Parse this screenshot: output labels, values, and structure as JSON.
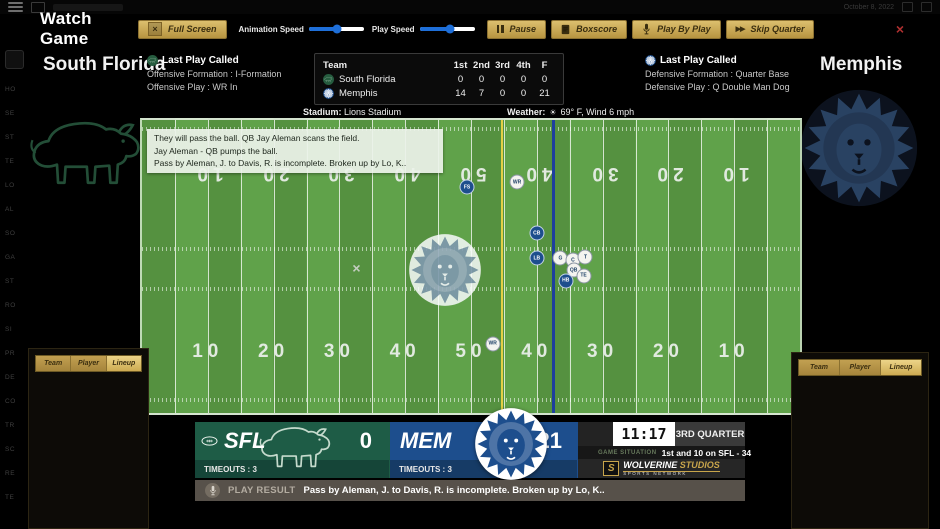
{
  "chrome": {
    "date": "October 8, 2022"
  },
  "toolbar": {
    "title": "Watch Game",
    "full_screen": "Full Screen",
    "animation_speed": "Animation Speed",
    "play_speed": "Play Speed",
    "pause": "Pause",
    "boxscore": "Boxscore",
    "play_by_play": "Play By Play",
    "skip_quarter": "Skip Quarter"
  },
  "sliders": {
    "animation_pct": 52,
    "play_pct": 55
  },
  "headers": {
    "home_team": "South Florida",
    "away_team": "Memphis",
    "home_last_play": {
      "title": "Last Play Called",
      "formation": "Offensive Formation : I-Formation",
      "play": "Offensive Play : WR In"
    },
    "away_last_play": {
      "title": "Last Play Called",
      "formation": "Defensive Formation : Quarter Base",
      "play": "Defensive Play : Q Double Man Dog"
    }
  },
  "score_table": {
    "headers": [
      "Team",
      "1st",
      "2nd",
      "3rd",
      "4th",
      "F"
    ],
    "rows": [
      {
        "team": "South Florida",
        "scores": [
          "0",
          "0",
          "0",
          "0",
          "0"
        ]
      },
      {
        "team": "Memphis",
        "scores": [
          "14",
          "7",
          "0",
          "0",
          "21"
        ]
      }
    ]
  },
  "info_line": {
    "stadium_label": "Stadium:",
    "stadium": "Lions Stadium",
    "weather_label": "Weather:",
    "weather": "69° F, Wind 6 mph"
  },
  "play_feed": [
    "They will pass the ball. QB Jay Aleman scans the field.",
    "Jay Aleman - QB pumps the ball.",
    "Pass by Aleman, J. to Davis, R. is incomplete. Broken up by Lo, K.."
  ],
  "field": {
    "numbers": [
      "10",
      "20",
      "30",
      "40",
      "50",
      "40",
      "30",
      "20",
      "10"
    ],
    "first_down_line_pct": 54.5,
    "scrimmage_line_pct": 62.3,
    "ball_spot": {
      "x": 32.6,
      "y": 50.5
    },
    "players": [
      {
        "label": "FS",
        "team": "blue",
        "x": 49.4,
        "y": 22.9
      },
      {
        "label": "WR",
        "team": "white",
        "x": 57.0,
        "y": 21.2
      },
      {
        "label": "CB",
        "team": "blue",
        "x": 60.0,
        "y": 38.7
      },
      {
        "label": "LB",
        "team": "blue",
        "x": 60.0,
        "y": 47.1
      },
      {
        "label": "G",
        "team": "white",
        "x": 63.6,
        "y": 47.1
      },
      {
        "label": "C",
        "team": "white",
        "x": 65.5,
        "y": 47.8
      },
      {
        "label": "T",
        "team": "white",
        "x": 67.4,
        "y": 46.8
      },
      {
        "label": "QB",
        "team": "white",
        "x": 65.6,
        "y": 51.2
      },
      {
        "label": "TE",
        "team": "white",
        "x": 67.1,
        "y": 53.2
      },
      {
        "label": "HB",
        "team": "blue",
        "x": 64.4,
        "y": 54.9
      },
      {
        "label": "WR",
        "team": "white",
        "x": 53.3,
        "y": 76.4
      }
    ]
  },
  "scoreboard": {
    "home": {
      "abbr": "SFL",
      "score": "0",
      "timeouts": "TIMEOUTS : 3"
    },
    "away": {
      "abbr": "MEM",
      "score": "21",
      "timeouts": "TIMEOUTS : 3"
    },
    "clock": "11:17",
    "quarter": "3RD QUARTER",
    "situation_label": "GAME SITUATION",
    "situation": "1st and 10 on SFL - 34",
    "network": {
      "name": "WOLVERINE",
      "suffix": "STUDIOS",
      "tagline": "SPORTS NETWORK"
    }
  },
  "play_result": {
    "label": "PLAY RESULT",
    "text": "Pass by Aleman, J. to Davis, R. is incomplete. Broken up by Lo, K.."
  },
  "panels": {
    "tabs": [
      "Team",
      "Player",
      "Lineup"
    ]
  },
  "nav_stubs": [
    "HO",
    "SE",
    "ST",
    "TE",
    "LO",
    "AL",
    "SO",
    "GA",
    "ST",
    "RO",
    "SI",
    "PR",
    "DE",
    "CO",
    "TR",
    "SC",
    "RE",
    "TE"
  ],
  "colors": {
    "gold": "#c8a54b",
    "home_green": "#1e5c46",
    "away_blue": "#1d4e8d",
    "field_light": "#60a24a",
    "field_dark": "#559140",
    "slider_blue": "#1e6fd9"
  }
}
